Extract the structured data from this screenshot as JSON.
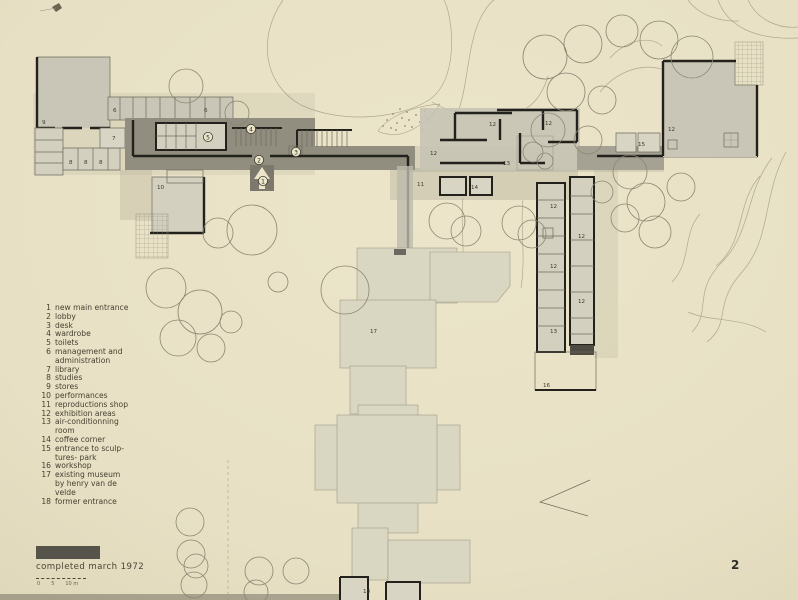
{
  "page": {
    "completed_text": "completed  march  1972",
    "page_number": "2",
    "scale_ticks": [
      "0",
      "5",
      "10 m"
    ]
  },
  "colors": {
    "paper": "#e9e2c6",
    "building_fill": "#c9c6b7",
    "corridor_dark": "#918e80",
    "museum_fill": "#d9d6c1",
    "wall": "#23211b"
  },
  "legend": {
    "items": [
      {
        "num": "1",
        "label": "new  main  entrance"
      },
      {
        "num": "2",
        "label": "lobby"
      },
      {
        "num": "3",
        "label": "desk"
      },
      {
        "num": "4",
        "label": "wardrobe"
      },
      {
        "num": "5",
        "label": "toilets"
      },
      {
        "num": "6",
        "label": "management  and\nadministration"
      },
      {
        "num": "7",
        "label": "library"
      },
      {
        "num": "8",
        "label": "studies"
      },
      {
        "num": "9",
        "label": "stores"
      },
      {
        "num": "10",
        "label": "performances"
      },
      {
        "num": "11",
        "label": "reproductions  shop"
      },
      {
        "num": "12",
        "label": "exhibition  areas"
      },
      {
        "num": "13",
        "label": "air-conditionning\nroom"
      },
      {
        "num": "14",
        "label": "coffee  corner"
      },
      {
        "num": "15",
        "label": "entrance  to  sculp-\ntures- park"
      },
      {
        "num": "16",
        "label": "workshop"
      },
      {
        "num": "17",
        "label": "existing  museum\nby  henry  van  de\nvelde"
      },
      {
        "num": "18",
        "label": "former  entrance"
      }
    ]
  },
  "plan": {
    "circled": [
      {
        "t": "1"
      },
      {
        "t": "2"
      },
      {
        "t": "3"
      },
      {
        "t": "4"
      },
      {
        "t": "5"
      }
    ],
    "labels": [
      {
        "t": "9"
      },
      {
        "t": "6"
      },
      {
        "t": "6"
      },
      {
        "t": "7"
      },
      {
        "t": "8"
      },
      {
        "t": "8"
      },
      {
        "t": "8"
      },
      {
        "t": "10"
      },
      {
        "t": "11"
      },
      {
        "t": "12"
      },
      {
        "t": "12"
      },
      {
        "t": "12"
      },
      {
        "t": "13"
      },
      {
        "t": "14"
      },
      {
        "t": "12"
      },
      {
        "t": "12"
      },
      {
        "t": "12"
      },
      {
        "t": "12"
      },
      {
        "t": "13"
      },
      {
        "t": "15"
      },
      {
        "t": "12"
      },
      {
        "t": "16"
      },
      {
        "t": "17"
      },
      {
        "t": "18"
      }
    ]
  }
}
